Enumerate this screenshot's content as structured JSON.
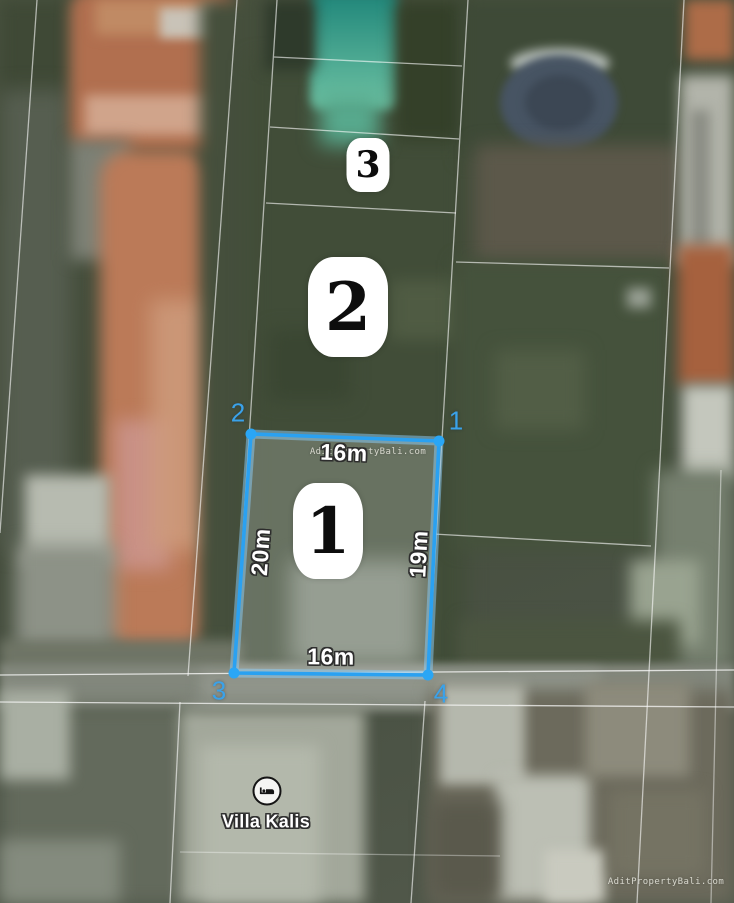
{
  "map": {
    "type": "aerial-property-plot-map",
    "colors": {
      "plot_outline_blue": "#2aa1f1",
      "corner_label_blue": "#3aa2ea",
      "badge_background": "#ffffff",
      "badge_number": "#0d0d0d",
      "cadastral_line": "#ffffff",
      "pool_teal": "#2e9a8a",
      "roof_terracotta": "#b4755c"
    },
    "plots": [
      {
        "id": "plot-1",
        "badge": "1",
        "selected": true,
        "dimensions": {
          "top": "16m",
          "left": "20m",
          "right": "19m",
          "bottom": "16m"
        },
        "corners": [
          {
            "label": "2",
            "position": "top-left"
          },
          {
            "label": "1",
            "position": "top-right"
          },
          {
            "label": "3",
            "position": "bottom-left"
          },
          {
            "label": "4",
            "position": "bottom-right"
          }
        ]
      },
      {
        "id": "plot-2",
        "badge": "2",
        "selected": false
      },
      {
        "id": "plot-3",
        "badge": "3",
        "selected": false
      }
    ],
    "poi": {
      "name": "Villa Kalis",
      "icon": "bed-lodging-icon"
    },
    "watermarks": {
      "center": "AditPropertyBali.com",
      "corner": "AditPropertyBali.com"
    }
  }
}
